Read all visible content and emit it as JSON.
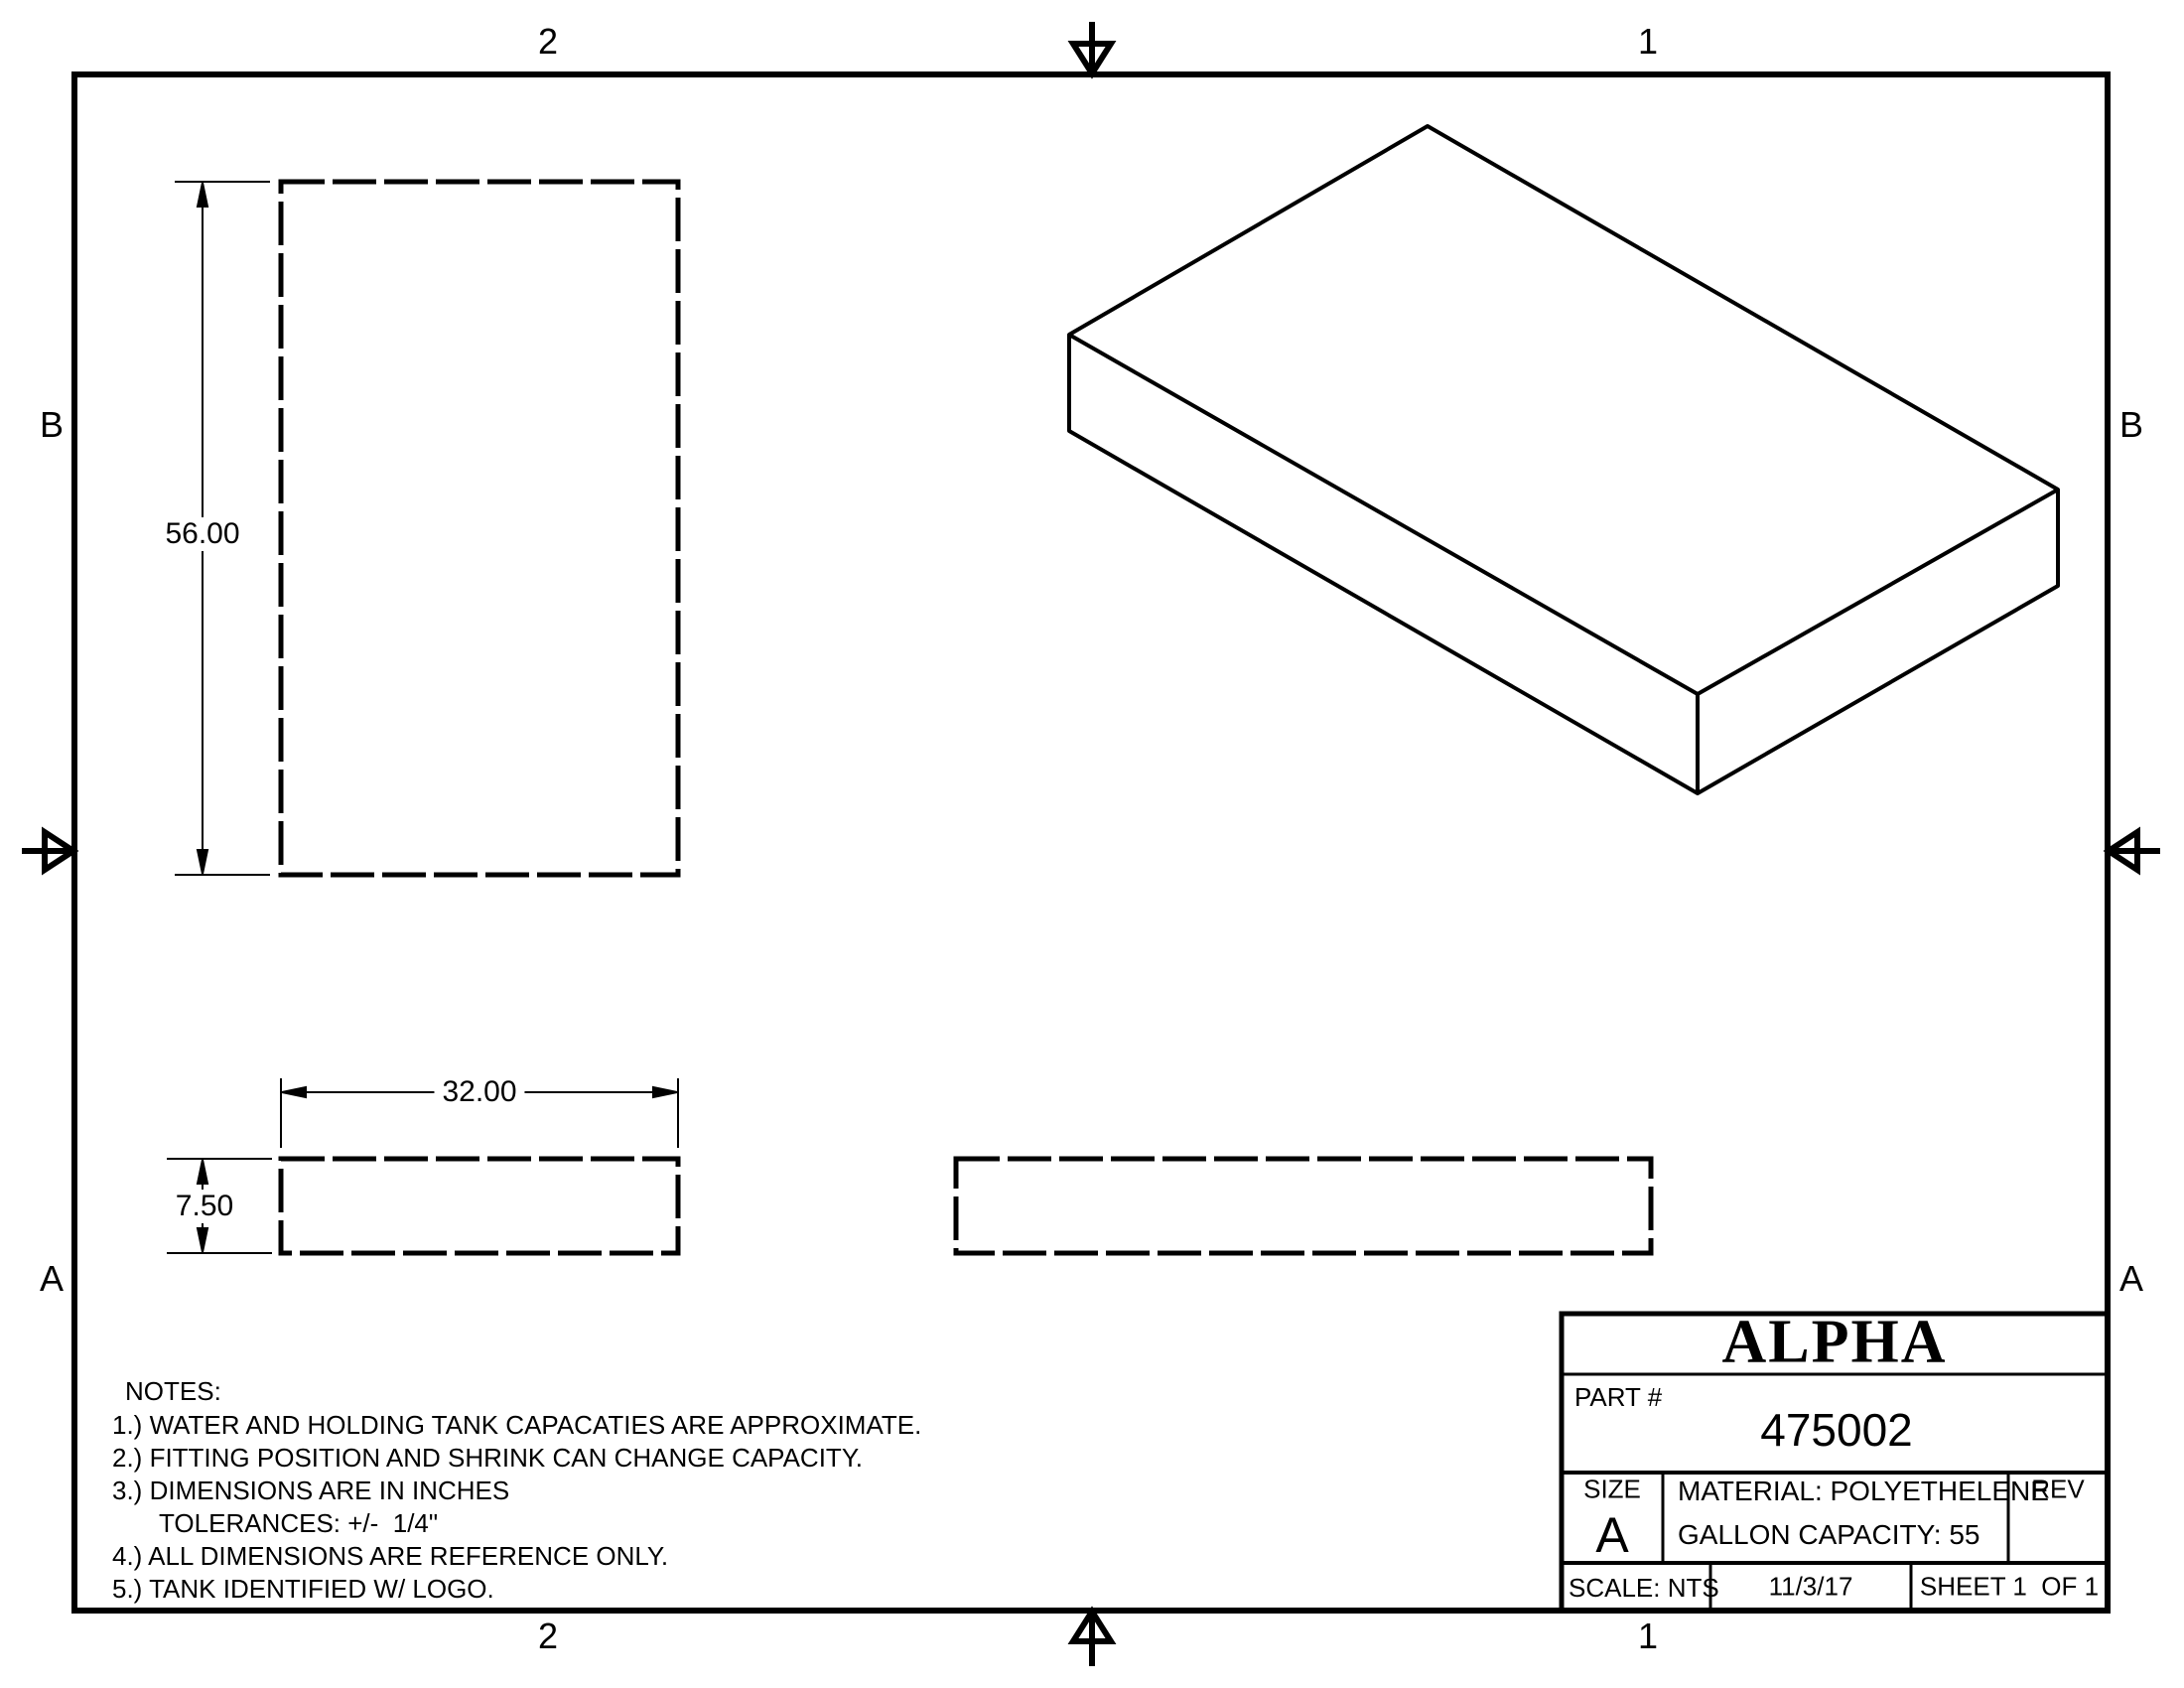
{
  "sheet": {
    "zones": {
      "top_left": "2",
      "top_right": "1",
      "bottom_left": "2",
      "bottom_right": "1",
      "left_upper": "B",
      "left_lower": "A",
      "right_upper": "B",
      "right_lower": "A"
    }
  },
  "dimensions": {
    "height": "56.00",
    "width": "32.00",
    "thickness": "7.50"
  },
  "notes": {
    "title": "NOTES:",
    "items": [
      "1.) WATER AND HOLDING TANK CAPACATIES ARE APPROXIMATE.",
      "2.) FITTING POSITION AND SHRINK CAN CHANGE CAPACITY.",
      "3.) DIMENSIONS ARE IN INCHES",
      "TOLERANCES: +/-  1/4\"",
      "4.) ALL DIMENSIONS ARE REFERENCE ONLY.",
      "5.) TANK IDENTIFIED W/ LOGO."
    ]
  },
  "title_block": {
    "company": "ALPHA",
    "part_label": "PART #",
    "part_number": "475002",
    "size_label": "SIZE",
    "size_value": "A",
    "material": "MATERIAL: POLYETHELENE",
    "capacity": "GALLON CAPACITY: 55",
    "rev_label": "REV",
    "scale": "SCALE: NTS",
    "date": "11/3/17",
    "sheet": "SHEET 1  OF 1"
  },
  "colors": {
    "ink": "#000000",
    "paper": "#ffffff"
  }
}
